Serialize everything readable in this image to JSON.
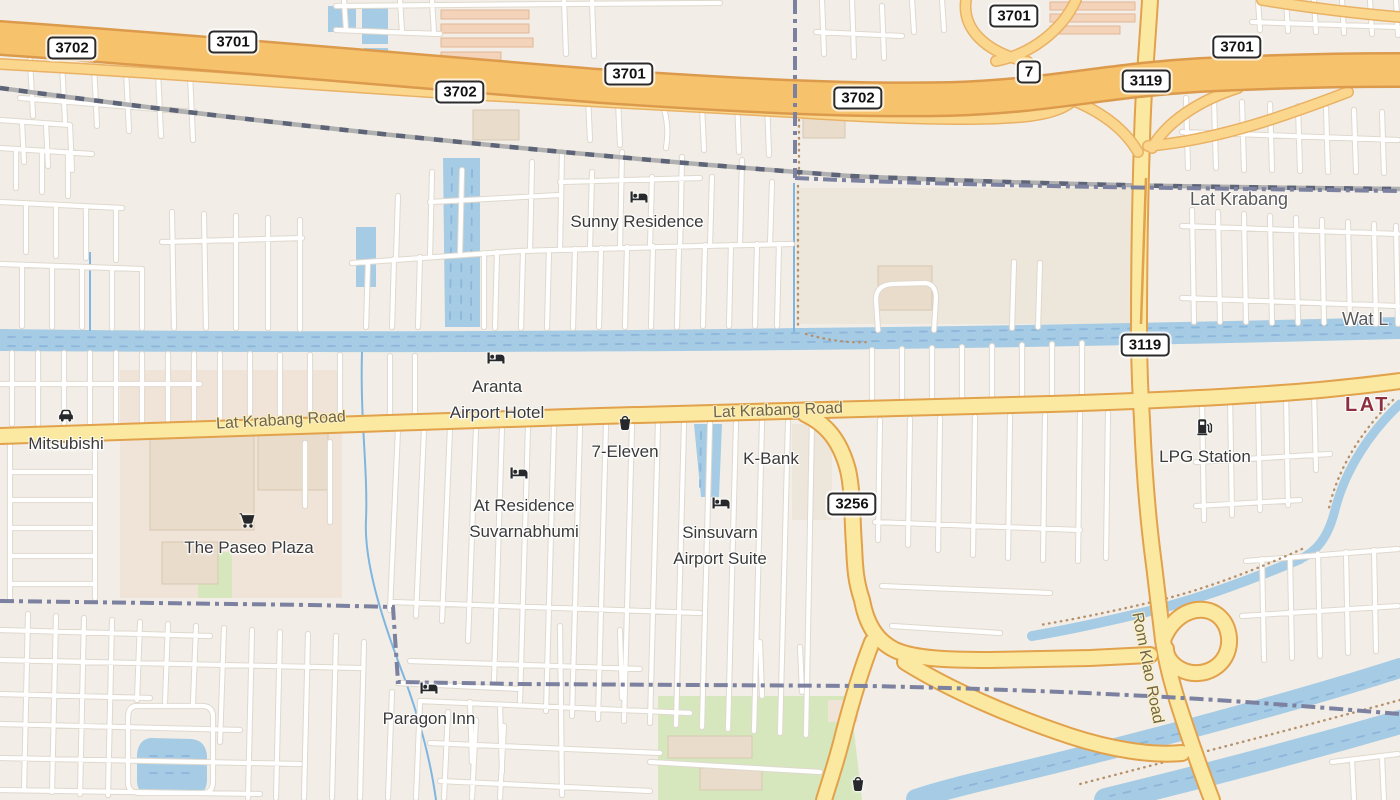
{
  "map_region": "Lat Krabang",
  "colors": {
    "bg": "#F2EEE7",
    "water": "#A6CBE4",
    "waterWave": "#8CB6DA",
    "motorway": "#F6C26C",
    "motorwayCasing": "#DC9A4C",
    "ramp": "#FBD78E",
    "rampCasing": "#E9B164",
    "primary": "#FBE8A1",
    "primaryCasing": "#E2A14B",
    "street": "#FFFFFF",
    "streetCasing": "#DFD8CD",
    "railBase": "#B0B0B0",
    "railDash": "#5E6477",
    "boundary": "#7C81A0",
    "building": "#E9DCCA",
    "buildingEdge": "#D8C8B2",
    "landuse": "#EDE6DA",
    "landusePink": "#F0E3D7",
    "tanRow": "#F3D3BA",
    "tanRowEdge": "#E2B794",
    "green": "#D6E7BE",
    "stream": "#7FB6E0",
    "pathDots": "#B5906B",
    "poiText": "#3A3A3A",
    "roadText": "#6F6548",
    "placeText": "#595959",
    "districtText": "#8E2F3F",
    "badgeBorder": "#2B2B2B"
  },
  "badges": [
    {
      "label": "3702"
    },
    {
      "label": "3701"
    },
    {
      "label": "3702"
    },
    {
      "label": "3701"
    },
    {
      "label": "3702"
    },
    {
      "label": "3701"
    },
    {
      "label": "7"
    },
    {
      "label": "3119"
    },
    {
      "label": "3701"
    },
    {
      "label": "3119"
    },
    {
      "label": "3256"
    }
  ],
  "pois": [
    {
      "name": "Sunny Residence",
      "icon": "hotel-icon",
      "lines": [
        "Sunny Residence"
      ]
    },
    {
      "name": "Aranta Airport Hotel",
      "icon": "hotel-icon",
      "lines": [
        "Aranta",
        "Airport Hotel"
      ]
    },
    {
      "name": "7-Eleven",
      "icon": "basket-icon",
      "lines": [
        "7-Eleven"
      ]
    },
    {
      "name": "K-Bank",
      "icon": null,
      "lines": [
        "K-Bank"
      ]
    },
    {
      "name": "At Residence Suvarnabhumi",
      "icon": "hotel-icon",
      "lines": [
        "At Residence",
        "Suvarnabhumi"
      ]
    },
    {
      "name": "Sinsuvarn Airport Suite",
      "icon": "hotel-icon",
      "lines": [
        "Sinsuvarn",
        "Airport Suite"
      ]
    },
    {
      "name": "Mitsubishi",
      "icon": "car-icon",
      "lines": [
        "Mitsubishi"
      ]
    },
    {
      "name": "The Paseo Plaza",
      "icon": "cart-icon",
      "lines": [
        "The Paseo Plaza"
      ]
    },
    {
      "name": "LPG Station",
      "icon": "fuel-icon",
      "lines": [
        "LPG Station"
      ]
    },
    {
      "name": "Paragon Inn",
      "icon": "hotel-icon",
      "lines": [
        "Paragon Inn"
      ]
    },
    {
      "name": "Convenience store south",
      "icon": "basket-icon",
      "lines": []
    }
  ],
  "roadLabels": [
    {
      "text": "Lat Krabang Road"
    },
    {
      "text": "Lat Krabang Road"
    },
    {
      "text": "Rom Klao Road"
    }
  ],
  "placeLabels": [
    {
      "text": "Lat Krabang"
    },
    {
      "text": "Wat L"
    },
    {
      "text": "LAT"
    }
  ]
}
